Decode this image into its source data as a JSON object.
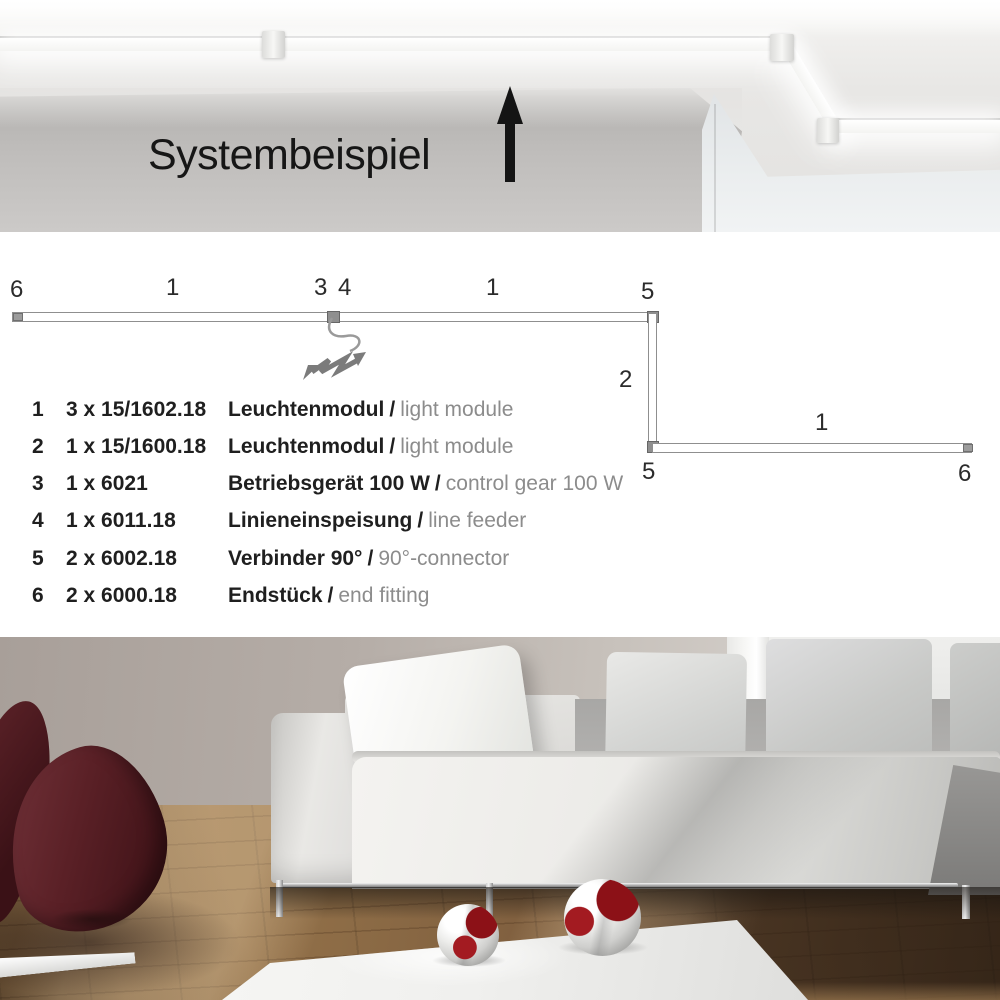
{
  "header": {
    "title": "Systembeispiel",
    "arrow_icon": "arrow-up"
  },
  "diagram": {
    "feed_icon": "lightning-bolt",
    "markers": [
      {
        "text": "6"
      },
      {
        "text": "1"
      },
      {
        "text": "3"
      },
      {
        "text": "4"
      },
      {
        "text": "1"
      },
      {
        "text": "5"
      },
      {
        "text": "2"
      },
      {
        "text": "5"
      },
      {
        "text": "1"
      },
      {
        "text": "6"
      }
    ]
  },
  "parts_list": {
    "separator": "/",
    "rows": [
      {
        "no": "1",
        "qty": "3 x 15/1602.18",
        "name_de": "Leuchtenmodul",
        "name_en": "light module"
      },
      {
        "no": "2",
        "qty": "1 x 15/1600.18",
        "name_de": "Leuchtenmodul",
        "name_en": "light module"
      },
      {
        "no": "3",
        "qty": "1 x 6021",
        "name_de": "Betriebsgerät 100 W",
        "name_en": "control gear 100 W"
      },
      {
        "no": "4",
        "qty": "1 x 6011.18",
        "name_de": "Linieneinspeisung",
        "name_en": "line feeder"
      },
      {
        "no": "5",
        "qty": "2 x 6002.18",
        "name_de": "Verbinder 90°",
        "name_en": "90°-connector"
      },
      {
        "no": "6",
        "qty": "2 x 6000.18",
        "name_de": "Endstück",
        "name_en": "end fitting"
      }
    ]
  },
  "colors": {
    "panel_background": "#ffffff",
    "diagram_line": "#8f8f8f",
    "text_primary": "#1f1f1f",
    "text_secondary": "#8c8c8c",
    "led_light": "#ffffff",
    "ceiling_gray": "#e3e2e0",
    "wall_gray": "#bfbdbb",
    "chair_burgundy": "#5a2026",
    "floor_wood": "#8d6c46",
    "ball_red": "#8c1117"
  }
}
